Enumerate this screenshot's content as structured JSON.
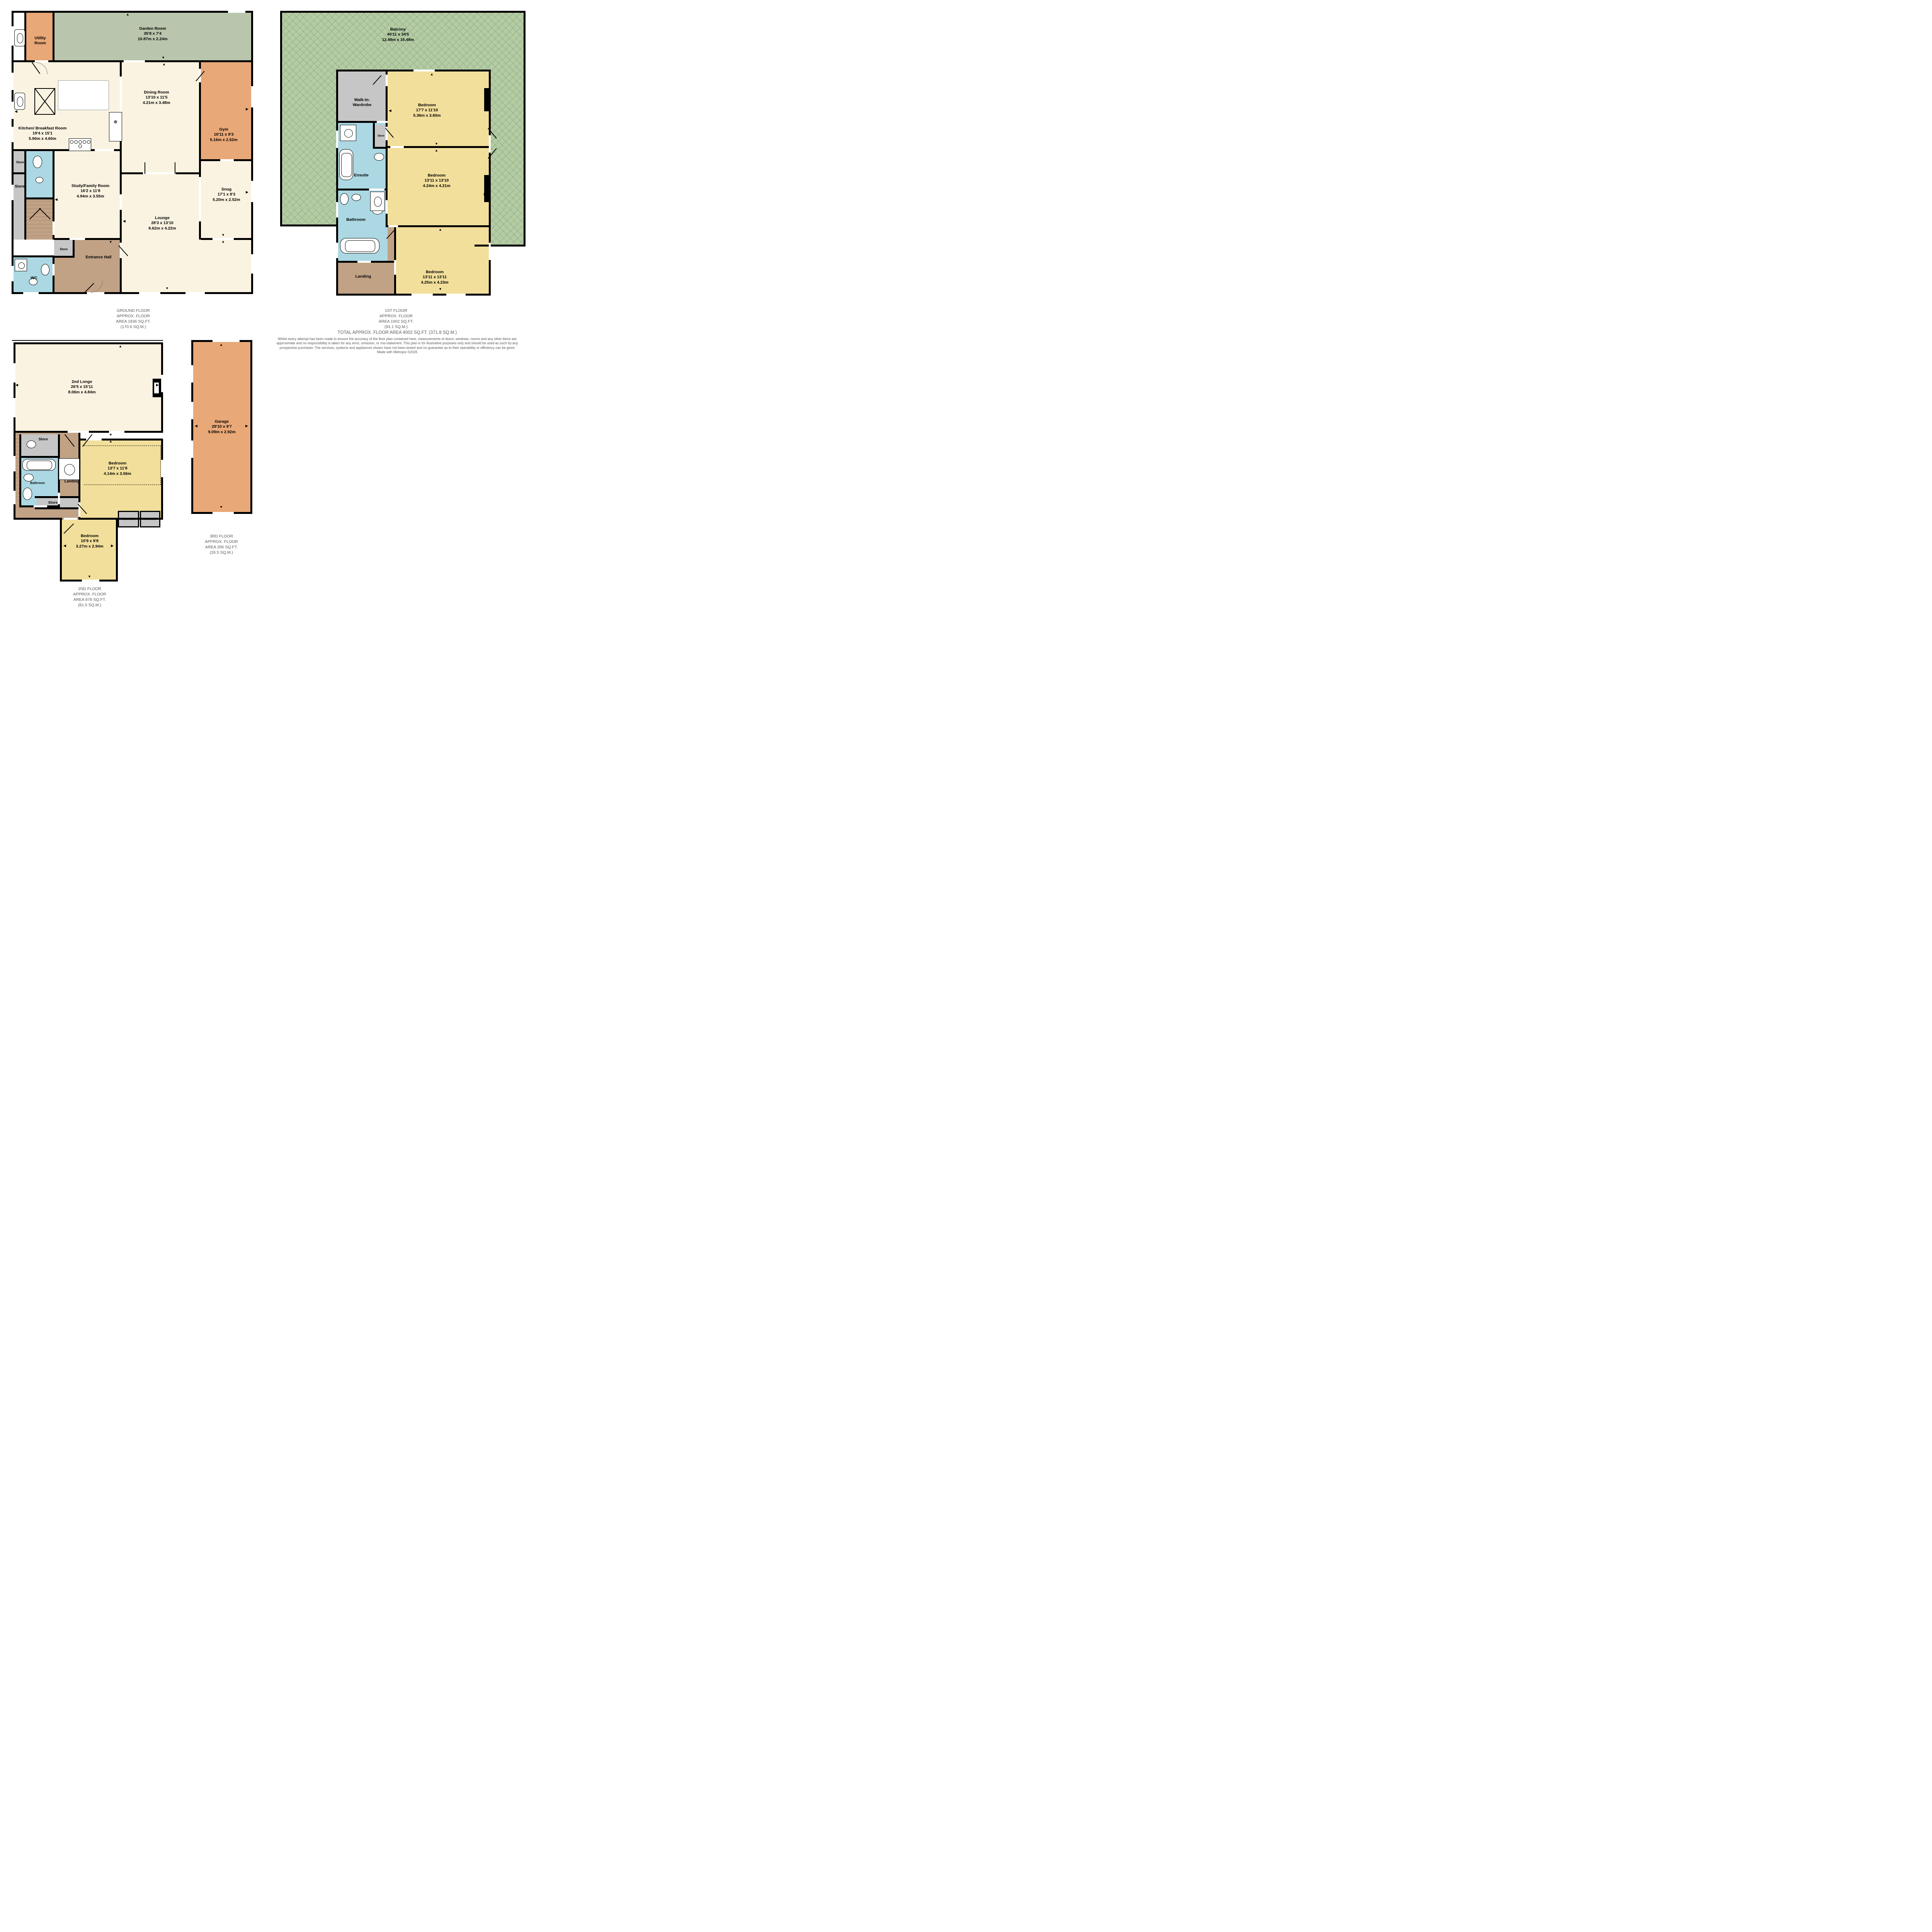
{
  "colors": {
    "wall": "#000000",
    "room_cream": "#faf3e1",
    "garden_green": "#b9c6ad",
    "balcony_green": "#b4cd9f",
    "orange_room": "#e9a877",
    "bedroom_yellow": "#f2df9b",
    "bathroom_blue": "#abd8e3",
    "hall_tan": "#c1a285",
    "store_gray": "#c6c6c6",
    "caption_gray": "#595959"
  },
  "ground": {
    "rooms": [
      {
        "name": "Garden Room",
        "imp": "35'8 x 7'4",
        "met": "10.87m x 2.24m"
      },
      {
        "name": "Utility Room"
      },
      {
        "name": "Kitchen/ Breakfast Room",
        "imp": "19'4 x 15'1",
        "met": "5.90m x 4.60m"
      },
      {
        "name": "Dining Room",
        "imp": "13'10 x 11'5",
        "met": "4.21m x 3.48m"
      },
      {
        "name": "Gym",
        "imp": "16'11 x 8'3",
        "met": "5.16m x 2.52m"
      },
      {
        "name": "Snug",
        "imp": "17'1 x 8'3",
        "met": "5.20m x 2.52m"
      },
      {
        "name": "Study/Family Room",
        "imp": "16'2 x 11'8",
        "met": "4.94m x 3.55m"
      },
      {
        "name": "Lounge",
        "imp": "28'3 x 13'10",
        "met": "8.62m x 4.22m"
      },
      {
        "name": "Entrance Hall"
      },
      {
        "name": "WC"
      },
      {
        "name": "Store"
      },
      {
        "name": "Store"
      },
      {
        "name": "Store"
      }
    ],
    "label": [
      "GROUND FLOOR",
      "APPROX. FLOOR",
      "AREA 1836 SQ.FT.",
      "(170.6 SQ.M.)"
    ]
  },
  "first": {
    "rooms": [
      {
        "name": "Balcony",
        "imp": "40'11 x 34'5",
        "met": "12.48m x 10.48m"
      },
      {
        "name": "Walk-In-Wardrobe"
      },
      {
        "name": "Bedroom",
        "imp": "17'7 x 11'10",
        "met": "5.36m x 3.60m"
      },
      {
        "name": "Ensuite"
      },
      {
        "name": "Bathroom"
      },
      {
        "name": "Bedroom",
        "imp": "13'11 x 13'10",
        "met": "4.24m x 4.21m"
      },
      {
        "name": "Bedroom",
        "imp": "13'11 x 13'11",
        "met": "4.25m x 4.23m"
      },
      {
        "name": "Landing"
      },
      {
        "name": "Store"
      }
    ],
    "label": [
      "1ST FLOOR",
      "APPROX. FLOOR",
      "AREA 1002 SQ.FT.",
      "(93.1 SQ.M.)"
    ]
  },
  "second": {
    "rooms": [
      {
        "name": "2nd Longe",
        "imp": "26'5 x 15'11",
        "met": "8.06m x 4.84m"
      },
      {
        "name": "Bedroom",
        "imp": "13'7 x 11'8",
        "met": "4.14m x 3.56m"
      },
      {
        "name": "Bedroom",
        "imp": "10'9 x 9'8",
        "met": "3.27m x 2.94m"
      },
      {
        "name": "Bathroom"
      },
      {
        "name": "Landing"
      },
      {
        "name": "Store"
      },
      {
        "name": "Store"
      },
      {
        "name": "Wardrobe"
      },
      {
        "name": "Wardrobe"
      }
    ],
    "label": [
      "2ND FLOOR",
      "APPROX. FLOOR",
      "AREA 878 SQ.FT.",
      "(81.5 SQ.M.)"
    ]
  },
  "third": {
    "rooms": [
      {
        "name": "Garage",
        "imp": "29'10 x 9'7",
        "met": "9.09m x 2.92m"
      }
    ],
    "label": [
      "3RD FLOOR",
      "APPROX. FLOOR",
      "AREA 286 SQ.FT.",
      "(26.5 SQ.M.)"
    ]
  },
  "footer": {
    "total": "TOTAL APPROX. FLOOR AREA 4002 SQ.FT. (371.8 SQ.M.)",
    "disclaimer": "Whilst every attempt has been made to ensure the accuracy of the floor plan contained here, measurements of doors, windows, rooms and any other items are approximate and no responsibility is taken for any error, omission, or mis-statement. This plan is for illustrative purposes only and should be used as such by any prospective purchaser. The services, systems and appliances shown have not been tested and no guarantee as to their operability or efficiency can be given",
    "credit": "Made with Metropix ©2025"
  }
}
